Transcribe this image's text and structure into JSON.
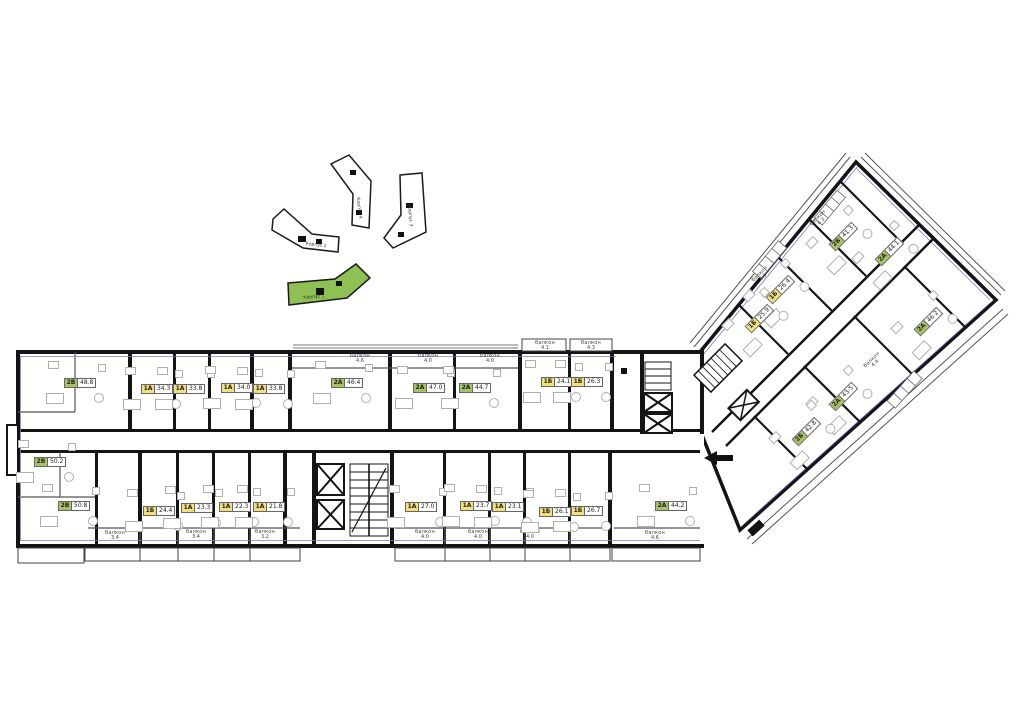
{
  "site_map": {
    "buildings": [
      {
        "label": "Корпус 4",
        "highlighted": false
      },
      {
        "label": "Корпус 3",
        "highlighted": false
      },
      {
        "label": "Корпус 2",
        "highlighted": false
      },
      {
        "label": "Корпус 1",
        "highlighted": true
      }
    ],
    "highlight_color": "#8fc054"
  },
  "plan": {
    "colors": {
      "one_room_badge": "#f2e07d",
      "two_room_badge": "#a9c263",
      "wall": "#141414",
      "accent": "#7b7bd0"
    },
    "balcony_word": "балкон",
    "units": [
      {
        "type": "2В",
        "area": "48.8",
        "x": 78,
        "y": 383,
        "rot": 0,
        "kind": "two_room"
      },
      {
        "type": "1А",
        "area": "34.3",
        "x": 155,
        "y": 389,
        "rot": 0,
        "kind": "one_room"
      },
      {
        "type": "1А",
        "area": "33.8",
        "x": 187,
        "y": 389,
        "rot": 0,
        "kind": "one_room"
      },
      {
        "type": "1А",
        "area": "34.0",
        "x": 235,
        "y": 388,
        "rot": 0,
        "kind": "one_room"
      },
      {
        "type": "1А",
        "area": "33.8",
        "x": 267,
        "y": 389,
        "rot": 0,
        "kind": "one_room"
      },
      {
        "type": "2А",
        "area": "46.4",
        "x": 345,
        "y": 383,
        "rot": 0,
        "kind": "two_room"
      },
      {
        "type": "2А",
        "area": "47.0",
        "x": 427,
        "y": 388,
        "rot": 0,
        "kind": "two_room"
      },
      {
        "type": "2А",
        "area": "44.7",
        "x": 473,
        "y": 388,
        "rot": 0,
        "kind": "two_room"
      },
      {
        "type": "1Б",
        "area": "24.1",
        "x": 555,
        "y": 382,
        "rot": 0,
        "kind": "one_room"
      },
      {
        "type": "1Б",
        "area": "26.3",
        "x": 585,
        "y": 382,
        "rot": 0,
        "kind": "one_room"
      },
      {
        "type": "2В",
        "area": "50.2",
        "x": 48,
        "y": 462,
        "rot": 0,
        "kind": "two_room"
      },
      {
        "type": "2В",
        "area": "50.8",
        "x": 72,
        "y": 506,
        "rot": 0,
        "kind": "two_room"
      },
      {
        "type": "1Б",
        "area": "24.4",
        "x": 157,
        "y": 511,
        "rot": 0,
        "kind": "one_room"
      },
      {
        "type": "1А",
        "area": "23.3",
        "x": 195,
        "y": 508,
        "rot": 0,
        "kind": "one_room"
      },
      {
        "type": "1А",
        "area": "22.3",
        "x": 233,
        "y": 507,
        "rot": 0,
        "kind": "one_room"
      },
      {
        "type": "1А",
        "area": "21.8",
        "x": 267,
        "y": 507,
        "rot": 0,
        "kind": "one_room"
      },
      {
        "type": "1А",
        "area": "27.0",
        "x": 419,
        "y": 507,
        "rot": 0,
        "kind": "one_room"
      },
      {
        "type": "1А",
        "area": "23.7",
        "x": 474,
        "y": 506,
        "rot": 0,
        "kind": "one_room"
      },
      {
        "type": "1А",
        "area": "23.1",
        "x": 506,
        "y": 507,
        "rot": 0,
        "kind": "one_room"
      },
      {
        "type": "1Б",
        "area": "26.1",
        "x": 553,
        "y": 512,
        "rot": 0,
        "kind": "one_room"
      },
      {
        "type": "1Б",
        "area": "26.7",
        "x": 585,
        "y": 511,
        "rot": 0,
        "kind": "one_room"
      },
      {
        "type": "2А",
        "area": "44.2",
        "x": 669,
        "y": 506,
        "rot": 0,
        "kind": "two_room"
      },
      {
        "type": "2Б",
        "area": "41.3",
        "x": 842,
        "y": 238,
        "rot": -45,
        "kind": "two_room"
      },
      {
        "type": "2А",
        "area": "44.1",
        "x": 888,
        "y": 253,
        "rot": -45,
        "kind": "two_room"
      },
      {
        "type": "2А",
        "area": "46.2",
        "x": 927,
        "y": 323,
        "rot": -45,
        "kind": "two_room"
      },
      {
        "type": "1Б",
        "area": "26.4",
        "x": 779,
        "y": 291,
        "rot": -45,
        "kind": "one_room"
      },
      {
        "type": "1Б",
        "area": "25.9",
        "x": 758,
        "y": 320,
        "rot": -45,
        "kind": "one_room"
      },
      {
        "type": "2А",
        "area": "43.5",
        "x": 842,
        "y": 398,
        "rot": -45,
        "kind": "two_room"
      },
      {
        "type": "2Б",
        "area": "42.8",
        "x": 805,
        "y": 433,
        "rot": -45,
        "kind": "two_room"
      }
    ],
    "balconies": [
      {
        "x": 360,
        "y": 359,
        "area": "4.6",
        "rot": 0
      },
      {
        "x": 428,
        "y": 359,
        "area": "4.0",
        "rot": 0
      },
      {
        "x": 490,
        "y": 359,
        "area": "4.0",
        "rot": 0
      },
      {
        "x": 545,
        "y": 346,
        "area": "4.1",
        "rot": 0
      },
      {
        "x": 591,
        "y": 346,
        "area": "4.3",
        "rot": 0
      },
      {
        "x": 115,
        "y": 536,
        "area": "3.4",
        "rot": 0
      },
      {
        "x": 196,
        "y": 535,
        "area": "3.4",
        "rot": 0
      },
      {
        "x": 265,
        "y": 535,
        "area": "3.2",
        "rot": 0
      },
      {
        "x": 425,
        "y": 535,
        "area": "4.0",
        "rot": 0
      },
      {
        "x": 478,
        "y": 535,
        "area": "4.0",
        "rot": 0
      },
      {
        "x": 530,
        "y": 535,
        "area": "4.0",
        "rot": 0
      },
      {
        "x": 655,
        "y": 536,
        "area": "4.6",
        "rot": 0
      },
      {
        "x": 762,
        "y": 276,
        "area": "4.3",
        "rot": -45
      },
      {
        "x": 820,
        "y": 220,
        "area": "4.3",
        "rot": -45
      },
      {
        "x": 874,
        "y": 362,
        "area": "4.4",
        "rot": -45
      }
    ]
  }
}
